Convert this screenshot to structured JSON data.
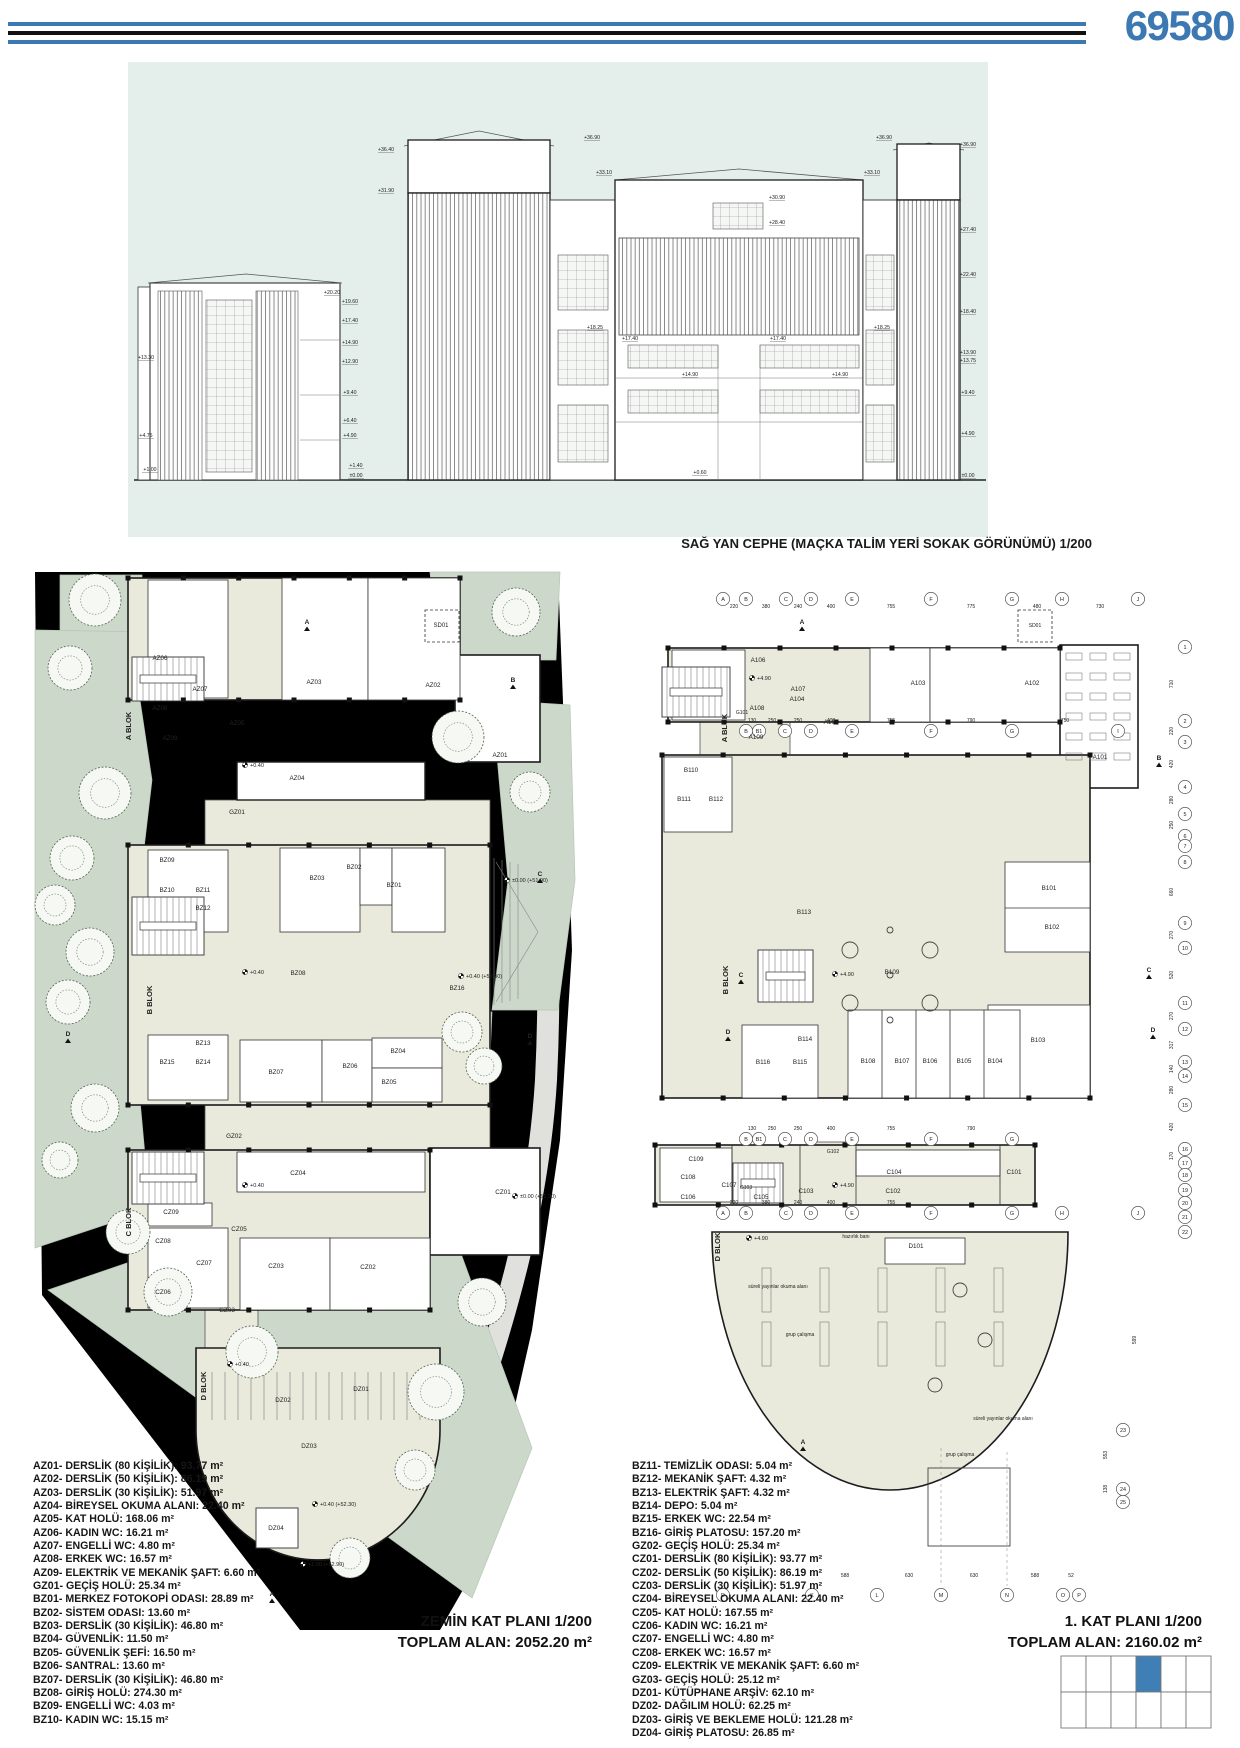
{
  "header": {
    "sheet_number": "69580"
  },
  "colors": {
    "accent_blue": "#3c78b2",
    "elevation_bg": "#e4efec",
    "site_green": "#ccd9ca",
    "court_green": "#bed1bf",
    "room_beige": "#e9e9dc",
    "wall": "#1c1c1c",
    "keyplan_highlight": "#3f7fb5"
  },
  "elevation": {
    "caption": "SAĞ YAN CEPHE (MAÇKA TALİM YERİ SOKAK GÖRÜNÜMÜ) 1/200",
    "levels_left_outer": [
      [
        "+13.30",
        146,
        359
      ],
      [
        "+4.75",
        146,
        437
      ],
      [
        "+1.00",
        150,
        471
      ]
    ],
    "levels_left": [
      [
        "+36.40",
        386,
        151
      ],
      [
        "+31.90",
        386,
        192
      ],
      [
        "+20.20",
        332,
        294
      ],
      [
        "+19.60",
        350,
        303
      ],
      [
        "+17.40",
        350,
        322
      ],
      [
        "+14.90",
        350,
        344
      ],
      [
        "+12.90",
        350,
        363
      ],
      [
        "+9.40",
        350,
        394
      ],
      [
        "+6.40",
        350,
        422
      ],
      [
        "+4.90",
        350,
        437
      ],
      [
        "+1.40",
        356,
        467
      ],
      [
        "±0.00",
        356,
        477
      ]
    ],
    "levels_center": [
      [
        "+36.90",
        592,
        139
      ],
      [
        "+36.90",
        884,
        139
      ],
      [
        "+33.10",
        604,
        174
      ],
      [
        "+33.10",
        872,
        174
      ],
      [
        "+30.90",
        777,
        199
      ],
      [
        "+28.40",
        777,
        224
      ],
      [
        "+18.25",
        595,
        329
      ],
      [
        "+18.25",
        882,
        329
      ],
      [
        "+17.40",
        630,
        340
      ],
      [
        "+17.40",
        778,
        340
      ],
      [
        "+14.90",
        690,
        376
      ],
      [
        "+14.90",
        840,
        376
      ],
      [
        "+0.60",
        700,
        474
      ]
    ],
    "levels_right": [
      [
        "+36.90",
        968,
        146
      ],
      [
        "+27.40",
        968,
        231
      ],
      [
        "+22.40",
        968,
        276
      ],
      [
        "+18.40",
        968,
        313
      ],
      [
        "+13.90",
        968,
        354
      ],
      [
        "+13.75",
        968,
        362
      ],
      [
        "+9.40",
        968,
        394
      ],
      [
        "+4.90",
        968,
        435
      ],
      [
        "±0.00",
        968,
        477
      ]
    ]
  },
  "plan_left": {
    "title": "ZEMİN KAT PLANI 1/200",
    "total": "TOPLAM ALAN: 2052.20 m²",
    "rooms": [
      [
        "AZ06",
        160,
        660
      ],
      [
        "AZ07",
        200,
        691
      ],
      [
        "AZ08",
        160,
        710
      ],
      [
        "AZ09",
        170,
        740
      ],
      [
        "AZ05",
        237,
        725
      ],
      [
        "AZ03",
        314,
        684
      ],
      [
        "AZ02",
        433,
        687
      ],
      [
        "AZ01",
        500,
        757
      ],
      [
        "AZ04",
        297,
        780
      ],
      [
        "GZ01",
        237,
        814
      ],
      [
        "BZ09",
        167,
        862
      ],
      [
        "BZ10",
        167,
        892
      ],
      [
        "BZ11",
        203,
        892
      ],
      [
        "BZ12",
        203,
        910
      ],
      [
        "BZ03",
        317,
        880
      ],
      [
        "BZ02",
        354,
        869
      ],
      [
        "BZ01",
        394,
        887
      ],
      [
        "BZ08",
        298,
        975
      ],
      [
        "BZ16",
        457,
        990
      ],
      [
        "BZ13",
        203,
        1045
      ],
      [
        "BZ14",
        203,
        1064
      ],
      [
        "BZ15",
        167,
        1064
      ],
      [
        "BZ07",
        276,
        1074
      ],
      [
        "BZ06",
        350,
        1068
      ],
      [
        "BZ04",
        398,
        1053
      ],
      [
        "BZ05",
        389,
        1084
      ],
      [
        "GZ02",
        234,
        1138
      ],
      [
        "CZ04",
        298,
        1175
      ],
      [
        "CZ01",
        503,
        1194
      ],
      [
        "CZ09",
        171,
        1214
      ],
      [
        "CZ05",
        239,
        1231
      ],
      [
        "CZ08",
        163,
        1243
      ],
      [
        "CZ07",
        204,
        1265
      ],
      [
        "CZ06",
        163,
        1294
      ],
      [
        "CZ03",
        276,
        1268
      ],
      [
        "CZ02",
        368,
        1269
      ],
      [
        "GZ03",
        227,
        1312
      ],
      [
        "DZ02",
        283,
        1402
      ],
      [
        "DZ01",
        361,
        1391
      ],
      [
        "DZ03",
        309,
        1448
      ],
      [
        "DZ04",
        276,
        1530
      ]
    ],
    "blocks": [
      [
        "A BLOK",
        131,
        726
      ],
      [
        "B BLOK",
        152,
        1000
      ],
      [
        "C BLOK",
        131,
        1222
      ],
      [
        "D BLOK",
        206,
        1386
      ]
    ],
    "levels": [
      [
        "+0.40",
        250,
        765
      ],
      [
        "+0.40",
        250,
        972
      ],
      [
        "+0.40 (+52.30)",
        466,
        976
      ],
      [
        "±0.00 (+51.90)",
        512,
        880
      ],
      [
        "+0.40",
        250,
        1185
      ],
      [
        "±0.00 (+51.90)",
        520,
        1196
      ],
      [
        "+0.40",
        235,
        1364
      ],
      [
        "+0.40 (+52.30)",
        320,
        1504
      ],
      [
        "+1.00 (+52.90)",
        308,
        1564
      ]
    ],
    "sections": [
      [
        "A",
        307,
        624
      ],
      [
        "A",
        272,
        1596
      ],
      [
        "B",
        513,
        682
      ],
      [
        "C",
        540,
        876
      ],
      [
        "D",
        530,
        1038
      ],
      [
        "D",
        68,
        1036
      ]
    ],
    "misc": [
      [
        "SD01",
        441,
        627
      ]
    ]
  },
  "plan_right": {
    "title": "1. KAT PLANI 1/200",
    "total": "TOPLAM ALAN: 2160.02 m²",
    "rooms": [
      [
        "A106",
        758,
        662
      ],
      [
        "A107",
        798,
        691
      ],
      [
        "A108",
        757,
        710
      ],
      [
        "A109",
        756,
        739
      ],
      [
        "A105",
        831,
        724
      ],
      [
        "A104",
        797,
        701
      ],
      [
        "A103",
        918,
        685
      ],
      [
        "A102",
        1032,
        685
      ],
      [
        "A101",
        1100,
        759
      ],
      [
        "B110",
        691,
        772
      ],
      [
        "B111",
        684,
        801
      ],
      [
        "B112",
        716,
        801
      ],
      [
        "B113",
        804,
        914
      ],
      [
        "B114",
        805,
        1041
      ],
      [
        "B115",
        800,
        1064
      ],
      [
        "B116",
        763,
        1064
      ],
      [
        "B109",
        892,
        974
      ],
      [
        "B101",
        1049,
        890
      ],
      [
        "B102",
        1052,
        929
      ],
      [
        "B103",
        1038,
        1042
      ],
      [
        "B108",
        868,
        1063
      ],
      [
        "B107",
        902,
        1063
      ],
      [
        "B106",
        930,
        1063
      ],
      [
        "B105",
        964,
        1063
      ],
      [
        "B104",
        995,
        1063
      ],
      [
        "C104",
        894,
        1174
      ],
      [
        "C101",
        1014,
        1174
      ],
      [
        "C105",
        761,
        1199
      ],
      [
        "C103",
        806,
        1193
      ],
      [
        "C102",
        893,
        1193
      ],
      [
        "C109",
        696,
        1161
      ],
      [
        "C108",
        688,
        1179
      ],
      [
        "C107",
        729,
        1187
      ],
      [
        "C106",
        688,
        1199
      ],
      [
        "D101",
        916,
        1248
      ]
    ],
    "blocks": [
      [
        "A BLOK",
        727,
        728
      ],
      [
        "B BLOK",
        728,
        980
      ],
      [
        "D BLOK",
        720,
        1247
      ]
    ],
    "levels": [
      [
        "+4.90",
        757,
        678
      ],
      [
        "+4.90",
        840,
        974
      ],
      [
        "+4.90",
        840,
        1185
      ],
      [
        "+4.90",
        754,
        1238
      ]
    ],
    "sections": [
      [
        "A",
        802,
        624
      ],
      [
        "A",
        803,
        1444
      ],
      [
        "B",
        1159,
        760
      ],
      [
        "C",
        741,
        977
      ],
      [
        "C",
        1149,
        972
      ],
      [
        "D",
        728,
        1034
      ],
      [
        "D",
        1153,
        1032
      ]
    ],
    "annotations": [
      [
        "süreli yayınlar okuma alanı",
        778,
        1288
      ],
      [
        "süreli yayınlar okuma alanı",
        1003,
        1420
      ],
      [
        "grup çalışma",
        800,
        1336
      ],
      [
        "grup çalışma",
        960,
        1456
      ],
      [
        "hazırlık banı",
        856,
        1238
      ],
      [
        "SD01",
        1035,
        627
      ],
      [
        "G101",
        742,
        714
      ],
      [
        "G102",
        833,
        1153
      ],
      [
        "G103",
        746,
        1189
      ]
    ],
    "bubbles": [
      [
        "A",
        723,
        599
      ],
      [
        "B",
        746,
        599
      ],
      [
        "C",
        786,
        599
      ],
      [
        "D",
        811,
        599
      ],
      [
        "E",
        852,
        599
      ],
      [
        "F",
        931,
        599
      ],
      [
        "G",
        1012,
        599
      ],
      [
        "H",
        1062,
        599
      ],
      [
        "J",
        1138,
        599
      ],
      [
        "B",
        746,
        731
      ],
      [
        "B1",
        759,
        731
      ],
      [
        "C",
        785,
        731
      ],
      [
        "D",
        811,
        731
      ],
      [
        "E",
        852,
        731
      ],
      [
        "F",
        931,
        731
      ],
      [
        "G",
        1012,
        731
      ],
      [
        "I",
        1118,
        731
      ],
      [
        "B",
        746,
        1139
      ],
      [
        "B1",
        759,
        1139
      ],
      [
        "C",
        785,
        1139
      ],
      [
        "D",
        811,
        1139
      ],
      [
        "E",
        852,
        1139
      ],
      [
        "F",
        931,
        1139
      ],
      [
        "G",
        1012,
        1139
      ],
      [
        "A",
        723,
        1213
      ],
      [
        "B",
        746,
        1213
      ],
      [
        "C",
        786,
        1213
      ],
      [
        "D",
        811,
        1213
      ],
      [
        "E",
        852,
        1213
      ],
      [
        "F",
        931,
        1213
      ],
      [
        "G",
        1012,
        1213
      ],
      [
        "H",
        1062,
        1213
      ],
      [
        "J",
        1138,
        1213
      ],
      [
        "D",
        723,
        1595
      ],
      [
        "K",
        812,
        1595
      ],
      [
        "L",
        877,
        1595
      ],
      [
        "M",
        941,
        1595
      ],
      [
        "N",
        1007,
        1595
      ],
      [
        "O",
        1063,
        1595
      ],
      [
        "P",
        1079,
        1595
      ],
      [
        "1",
        1185,
        647
      ],
      [
        "2",
        1185,
        721
      ],
      [
        "3",
        1185,
        742
      ],
      [
        "4",
        1185,
        787
      ],
      [
        "5",
        1185,
        814
      ],
      [
        "6",
        1185,
        836
      ],
      [
        "7",
        1185,
        846
      ],
      [
        "8",
        1185,
        862
      ],
      [
        "9",
        1185,
        923
      ],
      [
        "10",
        1185,
        948
      ],
      [
        "11",
        1185,
        1003
      ],
      [
        "12",
        1185,
        1029
      ],
      [
        "13",
        1185,
        1062
      ],
      [
        "14",
        1185,
        1076
      ],
      [
        "15",
        1185,
        1105
      ],
      [
        "16",
        1185,
        1149
      ],
      [
        "17",
        1185,
        1163
      ],
      [
        "18",
        1185,
        1175
      ],
      [
        "19",
        1185,
        1190
      ],
      [
        "20",
        1185,
        1203
      ],
      [
        "21",
        1185,
        1217
      ],
      [
        "22",
        1185,
        1232
      ],
      [
        "23",
        1123,
        1430
      ],
      [
        "24",
        1123,
        1489
      ],
      [
        "25",
        1123,
        1502
      ]
    ],
    "dims": [
      [
        "220",
        734,
        608
      ],
      [
        "380",
        766,
        608
      ],
      [
        "240",
        798,
        608
      ],
      [
        "400",
        831,
        608
      ],
      [
        "755",
        891,
        608
      ],
      [
        "775",
        971,
        608
      ],
      [
        "480",
        1037,
        608
      ],
      [
        "730",
        1100,
        608
      ],
      [
        "130",
        752,
        722
      ],
      [
        "250",
        772,
        722
      ],
      [
        "250",
        798,
        722
      ],
      [
        "400",
        831,
        722
      ],
      [
        "755",
        891,
        722
      ],
      [
        "790",
        971,
        722
      ],
      [
        "750",
        1065,
        722
      ],
      [
        "130",
        752,
        1130
      ],
      [
        "250",
        772,
        1130
      ],
      [
        "250",
        798,
        1130
      ],
      [
        "400",
        831,
        1130
      ],
      [
        "755",
        891,
        1130
      ],
      [
        "790",
        971,
        1130
      ],
      [
        "220",
        734,
        1204
      ],
      [
        "380",
        766,
        1204
      ],
      [
        "240",
        798,
        1204
      ],
      [
        "400",
        831,
        1204
      ],
      [
        "755",
        891,
        1204
      ],
      [
        "588",
        845,
        1577
      ],
      [
        "630",
        909,
        1577
      ],
      [
        "630",
        974,
        1577
      ],
      [
        "588",
        1035,
        1577
      ],
      [
        "52",
        1071,
        1577
      ],
      [
        "710",
        1173,
        684,
        -90
      ],
      [
        "220",
        1173,
        731,
        -90
      ],
      [
        "420",
        1173,
        764,
        -90
      ],
      [
        "280",
        1173,
        800,
        -90
      ],
      [
        "250",
        1173,
        825,
        -90
      ],
      [
        "660",
        1173,
        892,
        -90
      ],
      [
        "270",
        1173,
        935,
        -90
      ],
      [
        "520",
        1173,
        975,
        -90
      ],
      [
        "270",
        1173,
        1016,
        -90
      ],
      [
        "317",
        1173,
        1045,
        -90
      ],
      [
        "140",
        1173,
        1069,
        -90
      ],
      [
        "280",
        1173,
        1090,
        -90
      ],
      [
        "420",
        1173,
        1127,
        -90
      ],
      [
        "170",
        1173,
        1156,
        -90
      ],
      [
        "599",
        1136,
        1340,
        -90
      ],
      [
        "553",
        1107,
        1455,
        -90
      ],
      [
        "138",
        1107,
        1489,
        -90
      ]
    ]
  },
  "legend_left": [
    "AZ01- DERSLİK (80 KİŞİLİK): 93.77 m²",
    "AZ02- DERSLİK (50 KİŞİLİK): 86.19 m²",
    "AZ03- DERSLİK (30 KİŞİLİK): 51.97 m²",
    "AZ04- BİREYSEL OKUMA ALANI: 22.40 m²",
    "AZ05- KAT HOLÜ: 168.06 m²",
    "AZ06- KADIN WC: 16.21 m²",
    "AZ07- ENGELLİ WC: 4.80 m²",
    "AZ08- ERKEK WC: 16.57 m²",
    "AZ09- ELEKTRİK VE MEKANİK ŞAFT: 6.60 m²",
    "GZ01- GEÇİŞ HOLÜ: 25.34 m²",
    "BZ01- MERKEZ FOTOKOPİ ODASI: 28.89 m²",
    "BZ02- SİSTEM ODASI: 13.60 m²",
    "BZ03- DERSLİK (30 KİŞİLİK): 46.80 m²",
    "BZ04- GÜVENLİK: 11.50 m²",
    "BZ05- GÜVENLİK ŞEFİ: 16.50 m²",
    "BZ06- SANTRAL: 13.60 m²",
    "BZ07- DERSLİK (30 KİŞİLİK): 46.80 m²",
    "BZ08- GİRİŞ HOLÜ: 274.30 m²",
    "BZ09- ENGELLİ WC: 4.03 m²",
    "BZ10- KADIN WC: 15.15 m²"
  ],
  "legend_right": [
    "BZ11- TEMİZLİK ODASI: 5.04 m²",
    "BZ12- MEKANİK ŞAFT: 4.32 m²",
    "BZ13- ELEKTRİK ŞAFT: 4.32 m²",
    "BZ14- DEPO: 5.04 m²",
    "BZ15- ERKEK WC: 22.54 m²",
    "BZ16- GİRİŞ PLATOSU: 157.20 m²",
    "GZ02- GEÇİŞ HOLÜ: 25.34 m²",
    "CZ01- DERSLİK (80 KİŞİLİK): 93.77 m²",
    "CZ02- DERSLİK (50 KİŞİLİK): 86.19 m²",
    "CZ03- DERSLİK (30 KİŞİLİK): 51.97 m²",
    "CZ04- BİREYSEL OKUMA ALANI: 22.40 m²",
    "CZ05- KAT HOLÜ: 167.55 m²",
    "CZ06- KADIN WC: 16.21 m²",
    "CZ07- ENGELLİ WC: 4.80 m²",
    "CZ08- ERKEK WC: 16.57 m²",
    "CZ09- ELEKTRİK VE MEKANİK ŞAFT: 6.60 m²",
    "GZ03- GEÇİŞ HOLÜ: 25.12 m²",
    "DZ01- KÜTÜPHANE ARŞİV: 62.10 m²",
    "DZ02- DAĞILIM HOLÜ: 62.25 m²",
    "DZ03- GİRİŞ VE BEKLEME HOLÜ: 121.28 m²",
    "DZ04- GİRİŞ PLATOSU: 26.85 m²"
  ],
  "keyplan": {
    "cols": 6,
    "rows": 2,
    "highlight_col": 3,
    "highlight_row": 0
  }
}
